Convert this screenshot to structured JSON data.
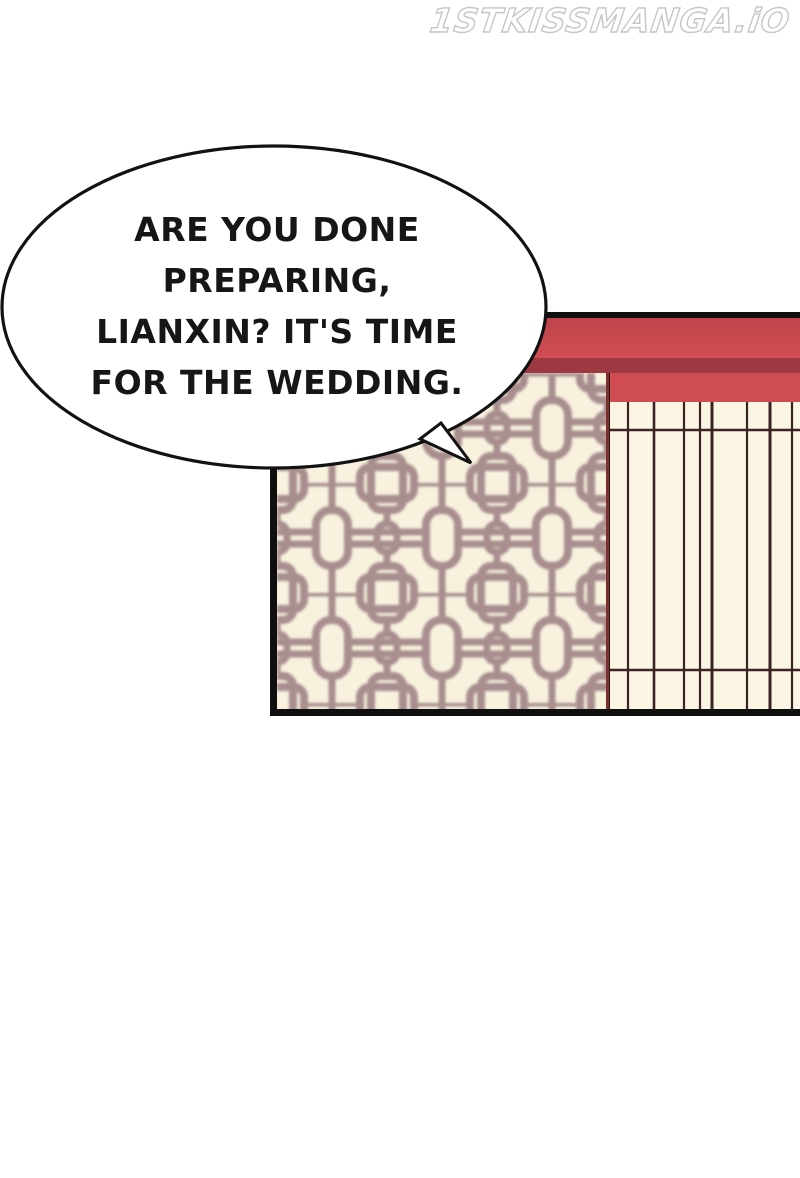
{
  "watermark": {
    "text": "1STKISSMANGA.iO"
  },
  "speech_bubble": {
    "speaker_text": "ARE YOU DONE PREPARING, LIANXIN? IT'S TIME FOR THE WEDDING.",
    "lines": [
      "ARE YOU DONE",
      "PREPARING,",
      "LIANXIN? IT'S TIME",
      "FOR THE WEDDING."
    ]
  },
  "panel": {
    "colors": {
      "roof_beam_red": "#c9484f",
      "roof_shadow_red": "#9d3a41",
      "wall_band_red": "#cf4c52",
      "lattice_background": "#f7f1de",
      "lattice_lines": "#a88e8e",
      "screen_background": "#fbf5e4",
      "screen_lines": "#3a2323",
      "screen_edge_maroon": "#7c2f2f",
      "panel_border": "#0f0f0f",
      "bubble_fill": "#ffffff",
      "bubble_outline": "#121212"
    }
  }
}
